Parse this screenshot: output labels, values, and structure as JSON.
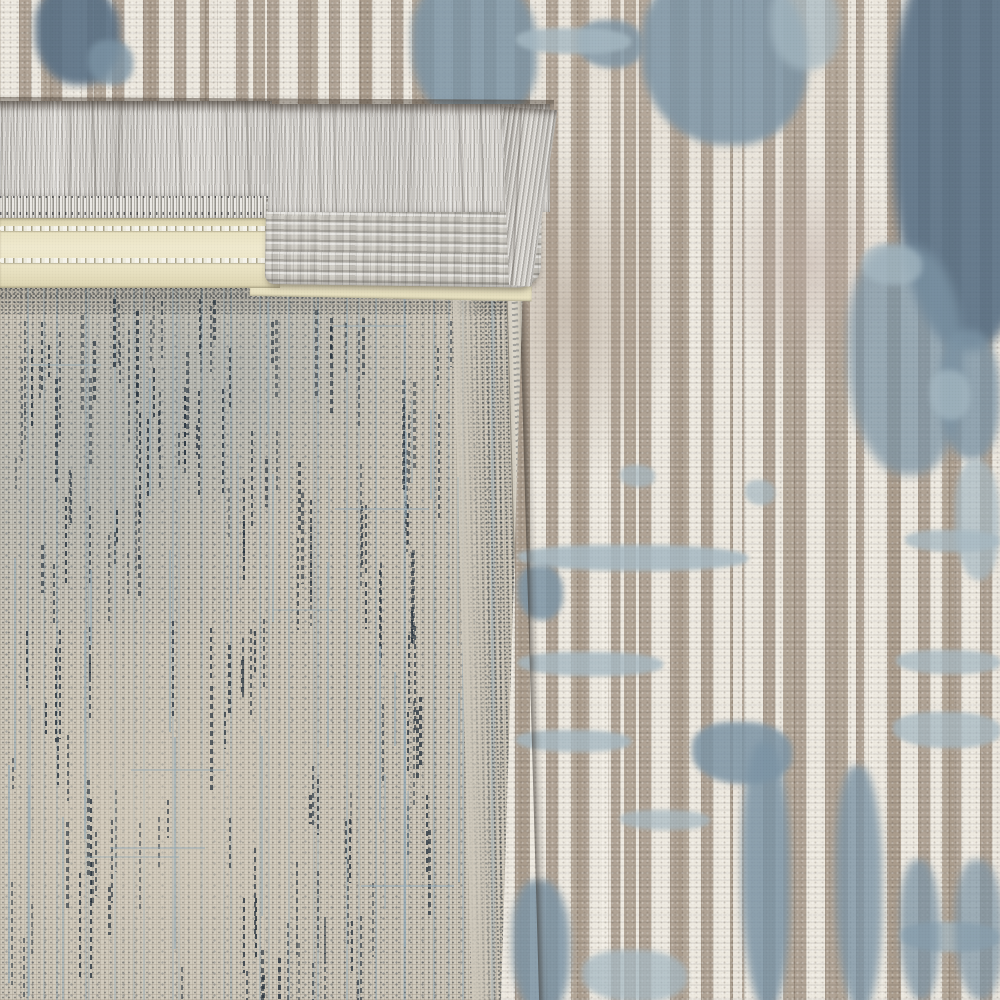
{
  "description": "Close-up photograph of a machine-woven area rug with its corner folded over: silver-gray fringe, a cream serged binding tape with white stitch rows, a flat-woven gray corner tab, and the exposed beige mesh backing flecked with indigo and pale-blue dashes occupy the left side; the rug face of ivory chenille ribs over a taupe ground with abstract slate-blue flecks fills the top and right.",
  "regions": {
    "front_pile": "Rug face: ivory pile ribs over taupe ground with slate-blue abstract flecks",
    "fringe": "Silver-gray fringe threads along the folded edge",
    "warp_header": "Woven warp header band above the binding tape",
    "binding_tape": "Cream binding tape with twin white stitch rows",
    "corner_tab": "Flat-woven gray corner tab overlapping the binding",
    "backing": "Exposed rug backing: fine beige mesh with indigo and pale-blue warp dashes"
  },
  "palette": {
    "pile_cream": "#eee9de",
    "pile_taupe": "#b1a496",
    "blue_dark": "#5a7186",
    "blue_mid": "#7d95a6",
    "blue_light": "#a7bac4",
    "fringe_gray": "#c9c6c1",
    "tape_yellow": "#ece5c6",
    "backing_ground": "#d1cbbe",
    "dash_navy": "#2c3e4e",
    "warp_blue": "#96acb8"
  }
}
